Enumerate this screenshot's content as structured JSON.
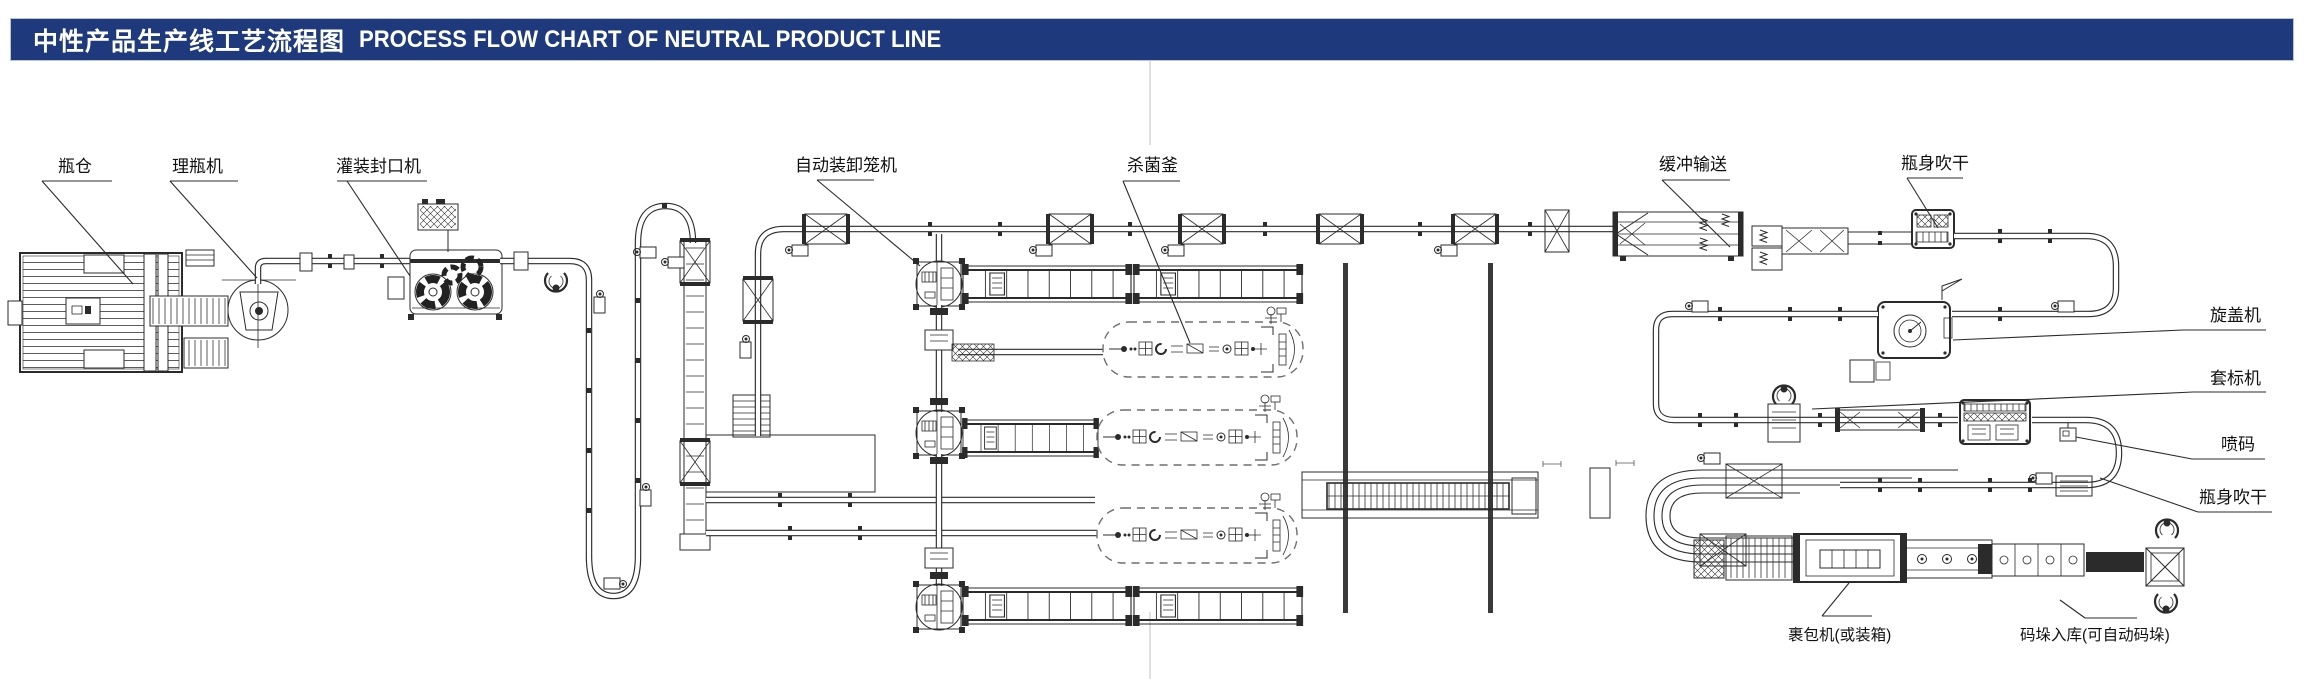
{
  "title_bar": {
    "zh": "中性产品生产线工艺流程图",
    "en": "PROCESS FLOW CHART OF NEUTRAL PRODUCT LINE",
    "bg_color": "#1e3a7c",
    "text_color": "#ffffff"
  },
  "diagram": {
    "line_color": "#2b2b2b",
    "wall_color": "#3a3a3a",
    "dashed_vessel_color": "#6e6e6e",
    "labels": {
      "bottle_silo": "瓶仓",
      "unscrambler": "理瓶机",
      "filler_capper": "灌装封口机",
      "cage_loader": "自动装卸笼机",
      "sterilizer": "杀菌釜",
      "buffer_conveyor": "缓冲输送",
      "dryer_top": "瓶身吹干",
      "capping_machine": "旋盖机",
      "sleeve_labeler": "套标机",
      "inkjet_coder": "喷码",
      "dryer_right": "瓶身吹干",
      "wrapper": "裹包机(或装箱)",
      "palletizing": "码垛入库(可自动码垛)"
    }
  }
}
